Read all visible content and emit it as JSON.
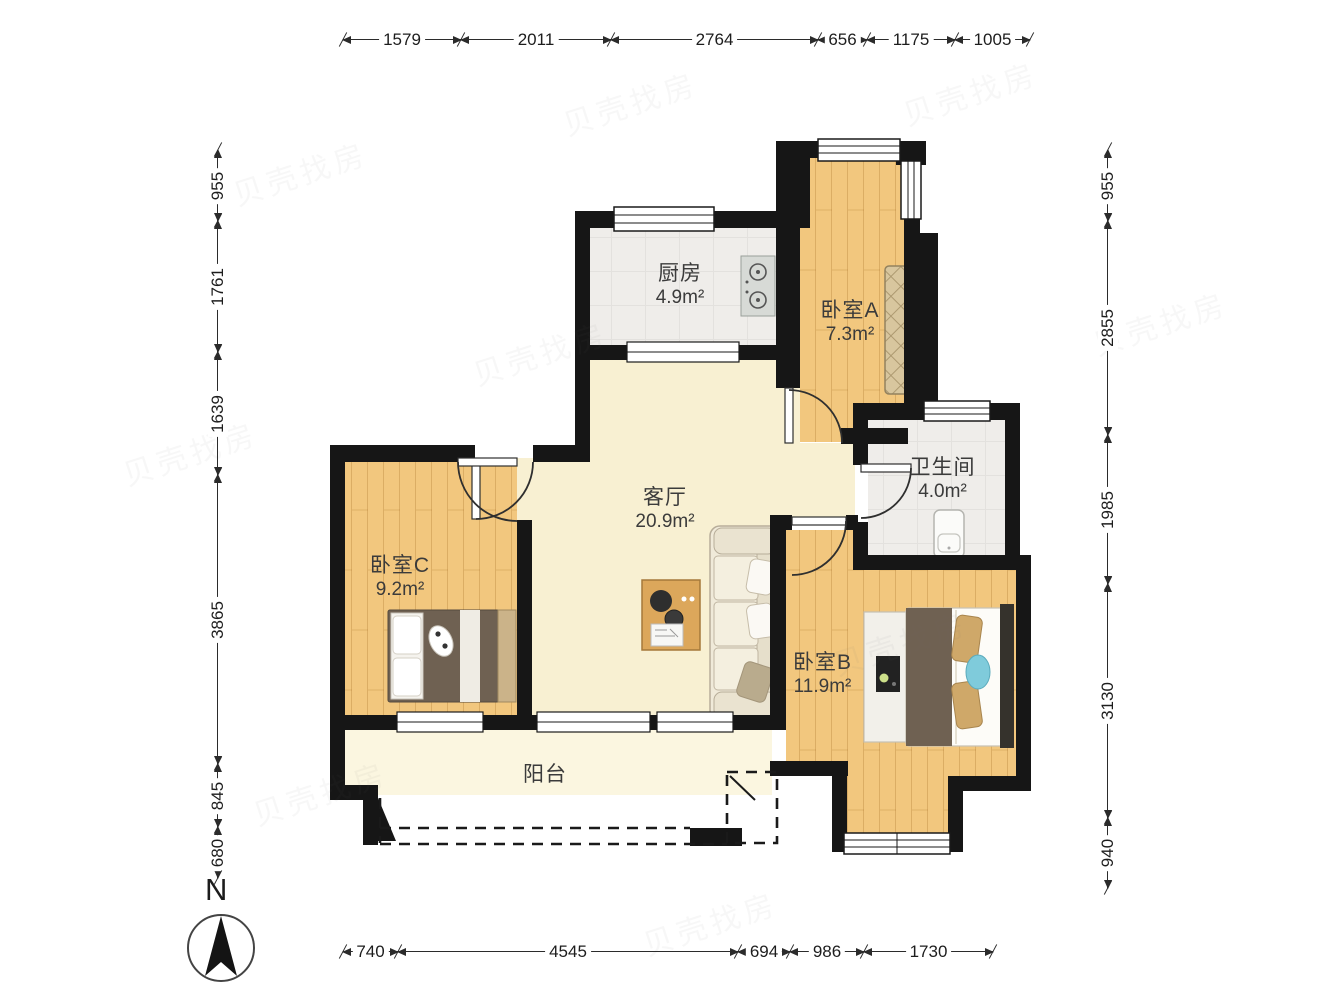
{
  "plan": {
    "rooms": [
      {
        "name": "厨房",
        "area": "4.9m²"
      },
      {
        "name": "卧室A",
        "area": "7.3m²"
      },
      {
        "name": "卫生间",
        "area": "4.0m²"
      },
      {
        "name": "客厅",
        "area": "20.9m²"
      },
      {
        "name": "卧室C",
        "area": "9.2m²"
      },
      {
        "name": "卧室B",
        "area": "11.9m²"
      },
      {
        "name": "阳台",
        "area": ""
      }
    ],
    "compass_label": "N",
    "watermark_text": "贝壳找房",
    "colors": {
      "wall": "#161616",
      "wood_floor": "#f2c77e",
      "tile_floor": "#efedea",
      "living_floor": "#f8f0d2",
      "balcony_floor": "#fbf6e0",
      "dim_line": "#2b2b2b"
    }
  },
  "dimensions": {
    "top": [
      "1579",
      "2011",
      "2764",
      "656",
      "1175",
      "1005"
    ],
    "bottom": [
      "740",
      "4545",
      "694",
      "986",
      "1730"
    ],
    "left": [
      "955",
      "1761",
      "1639",
      "3865",
      "845",
      "680"
    ],
    "right": [
      "955",
      "2855",
      "1985",
      "3130",
      "940"
    ]
  }
}
